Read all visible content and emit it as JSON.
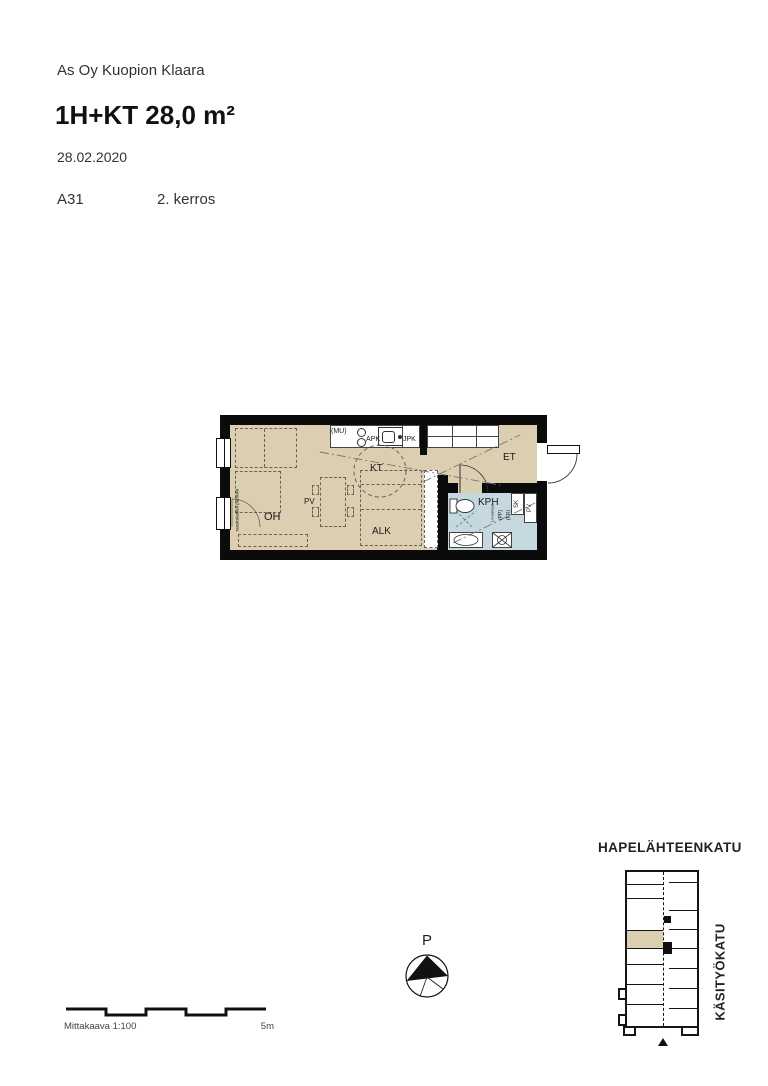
{
  "header": {
    "project": "As Oy Kuopion Klaara",
    "apartment_type": "1H+KT 28,0 m²",
    "date": "28.02.2020",
    "unit_id": "A31",
    "floor": "2. kerros"
  },
  "floorplan": {
    "rooms": {
      "oh": "OH",
      "kt": "KT",
      "et": "ET",
      "alk": "ALK",
      "kph": "KPH"
    },
    "labels": {
      "pv": "PV",
      "mu": "(MU)",
      "apk": "APK",
      "jpk": "JPK",
      "sk": "SK",
      "pk": "PV",
      "pp": "(PP)",
      "kr": "(KR)",
      "lv_varaus": "LV-varaus",
      "french_balcony": "ranskalainen parveke"
    },
    "colors": {
      "floor": "#dccfb1",
      "bathroom": "#c5d8e0",
      "wall": "#0b0b0b"
    }
  },
  "compass": {
    "north_label": "P"
  },
  "scale_bar": {
    "caption": "Mittakaava 1:100",
    "max_label": "5m"
  },
  "site_map": {
    "street_top": "HAPELÄHTEENKATU",
    "street_right": "KÄSITYÖKATU"
  }
}
